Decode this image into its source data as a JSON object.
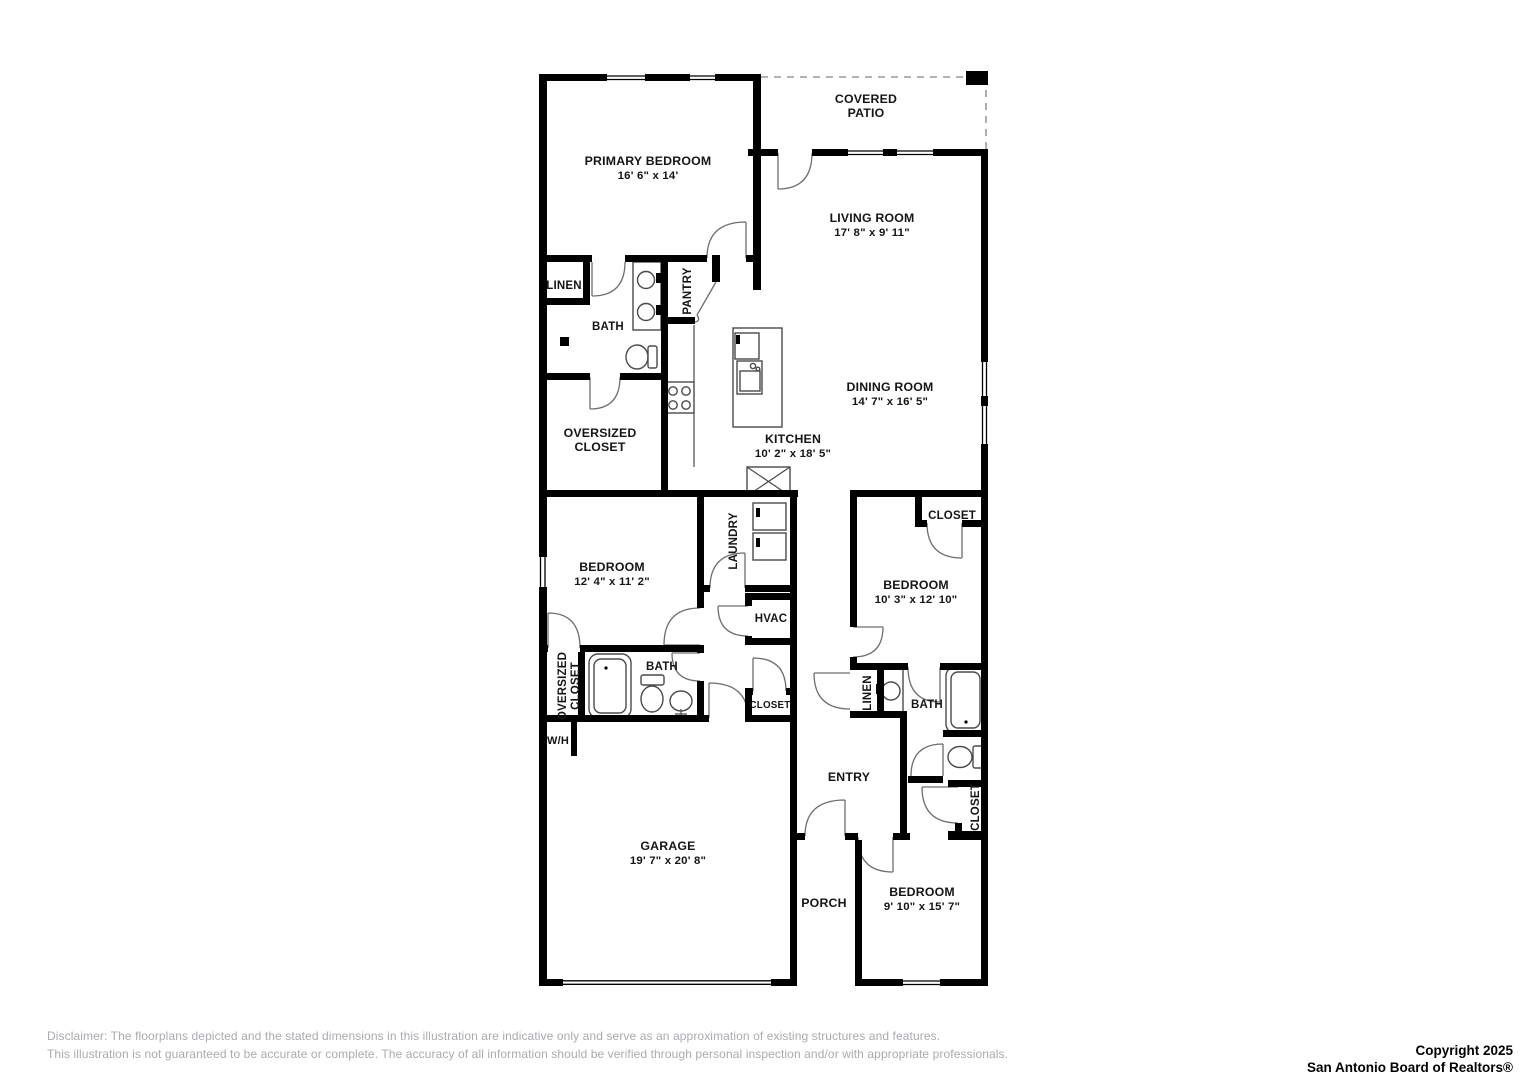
{
  "page": {
    "width": 1527,
    "height": 1080,
    "background": "#ffffff",
    "wall_color": "#000000"
  },
  "floorplan": {
    "rooms": [
      {
        "id": "covered-patio",
        "lines": [
          "COVERED",
          "PATIO"
        ],
        "x": 866,
        "y": 103
      },
      {
        "id": "primary-bedroom",
        "lines": [
          "PRIMARY BEDROOM"
        ],
        "dims": "16' 6\" x 14'",
        "x": 648,
        "y": 165
      },
      {
        "id": "living-room",
        "lines": [
          "LIVING ROOM"
        ],
        "dims": "17' 8\" x 9' 11\"",
        "x": 872,
        "y": 222
      },
      {
        "id": "linen-primary",
        "lines": [
          "LINEN"
        ],
        "x": 564,
        "y": 289,
        "size": 11.5
      },
      {
        "id": "bath-primary",
        "lines": [
          "BATH"
        ],
        "x": 608,
        "y": 330,
        "size": 11.5
      },
      {
        "id": "pantry",
        "lines": [
          "PANTRY"
        ],
        "x": 691,
        "y": 291,
        "vertical": true,
        "size": 11.5
      },
      {
        "id": "oversized-closet-primary",
        "lines": [
          "OVERSIZED",
          "CLOSET"
        ],
        "x": 600,
        "y": 437
      },
      {
        "id": "kitchen",
        "lines": [
          "KITCHEN"
        ],
        "dims": "10' 2\" x 18' 5\"",
        "x": 793,
        "y": 443
      },
      {
        "id": "dining-room",
        "lines": [
          "DINING ROOM"
        ],
        "dims": "14' 7\" x 16' 5\"",
        "x": 890,
        "y": 391
      },
      {
        "id": "bedroom-2",
        "lines": [
          "BEDROOM"
        ],
        "dims": "12' 4\" x 11' 2\"",
        "x": 612,
        "y": 571
      },
      {
        "id": "laundry",
        "lines": [
          "LAUNDRY"
        ],
        "x": 737,
        "y": 541,
        "vertical": true,
        "size": 11.5
      },
      {
        "id": "hvac",
        "lines": [
          "HVAC"
        ],
        "x": 771,
        "y": 622,
        "size": 11.5
      },
      {
        "id": "closet-hall",
        "lines": [
          "CLOSET"
        ],
        "x": 770,
        "y": 708,
        "size": 9.8
      },
      {
        "id": "closet-bedroom3",
        "lines": [
          "CLOSET"
        ],
        "x": 952,
        "y": 519,
        "size": 11.5
      },
      {
        "id": "bedroom-3",
        "lines": [
          "BEDROOM"
        ],
        "dims": "10' 3\" x 12' 10\"",
        "x": 916,
        "y": 589
      },
      {
        "id": "oversized-closet-2",
        "lines": [
          "OVERSIZED",
          "CLOSET"
        ],
        "x": 566,
        "y": 686,
        "vertical": true,
        "size": 11.5
      },
      {
        "id": "bath-2",
        "lines": [
          "BATH"
        ],
        "x": 662,
        "y": 670,
        "size": 11.5
      },
      {
        "id": "water-heater",
        "lines": [
          "W/H"
        ],
        "x": 558,
        "y": 744,
        "size": 11
      },
      {
        "id": "garage",
        "lines": [
          "GARAGE"
        ],
        "dims": "19' 7\" x 20' 8\"",
        "x": 668,
        "y": 850
      },
      {
        "id": "entry",
        "lines": [
          "ENTRY"
        ],
        "x": 849,
        "y": 781
      },
      {
        "id": "linen-2",
        "lines": [
          "LINEN"
        ],
        "x": 871,
        "y": 693,
        "vertical": true,
        "size": 11.5
      },
      {
        "id": "bath-3",
        "lines": [
          "BATH"
        ],
        "x": 927,
        "y": 708,
        "size": 11.5
      },
      {
        "id": "closet-bedroom4",
        "lines": [
          "CLOSET"
        ],
        "x": 979,
        "y": 807,
        "vertical": true,
        "size": 11.5
      },
      {
        "id": "porch",
        "lines": [
          "PORCH"
        ],
        "x": 824,
        "y": 907
      },
      {
        "id": "bedroom-4",
        "lines": [
          "BEDROOM"
        ],
        "dims": "9' 10\" x 15' 7\"",
        "x": 922,
        "y": 896
      }
    ]
  },
  "footer": {
    "disclaimer_line1": "Disclaimer: The floorplans depicted and the stated dimensions in this illustration are indicative only and serve as an approximation of existing structures and features.",
    "disclaimer_line2": "This illustration is not guaranteed to be accurate or complete. The accuracy of all information should be verified through personal inspection and/or with appropriate professionals.",
    "copyright_line1": "Copyright 2025",
    "copyright_line2": "San Antonio Board of Realtors®"
  }
}
